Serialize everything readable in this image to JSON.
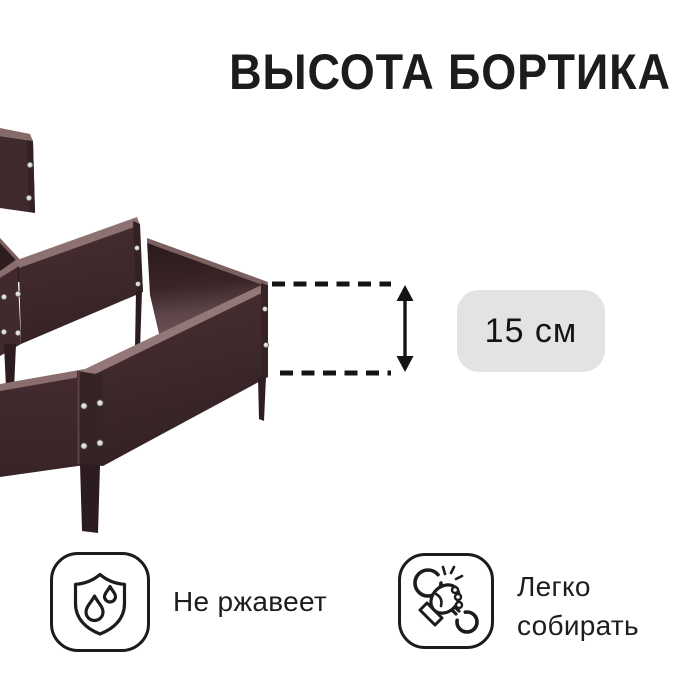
{
  "title": "ВЫСОТА БОРТИКА",
  "measurement": {
    "value": "15 см"
  },
  "features": [
    {
      "icon": "shield-drops-icon",
      "lines": [
        "Не ржавеет"
      ]
    },
    {
      "icon": "hand-wrench-icon",
      "lines": [
        "Легко",
        "собирать"
      ]
    }
  ],
  "product": {
    "name": "garden-bed-three-tier"
  },
  "colors": {
    "badge_bg": "#E3E3E3",
    "text_primary": "#1C1C1C",
    "line_black": "#141414",
    "background": "#FFFFFF",
    "panel_brown": "#3E292C",
    "panel_brown_dark": "#2E1D20",
    "panel_rim_light": "#937877",
    "rivet_gray": "#D8D8D8"
  }
}
